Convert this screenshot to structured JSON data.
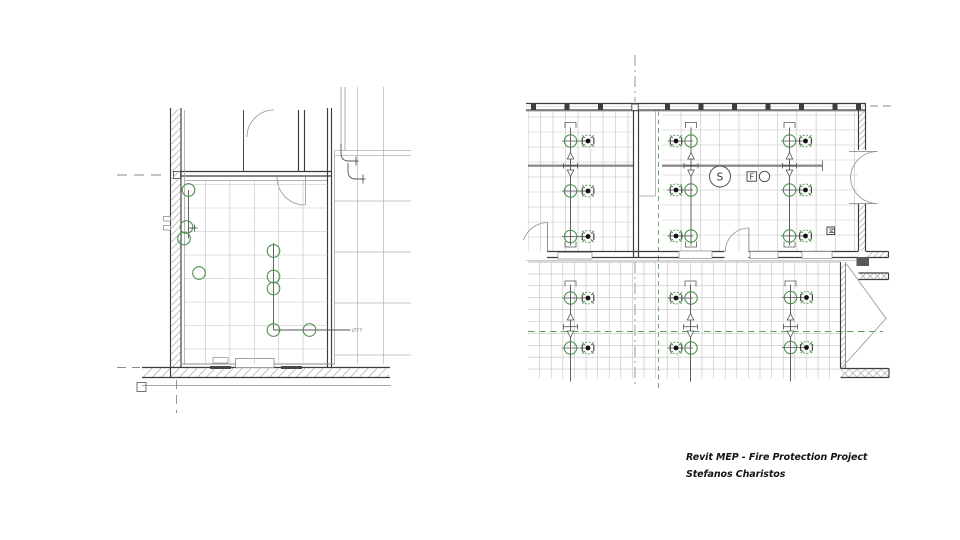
{
  "annotation": {
    "line1": "Revit MEP - Fire Protection Project",
    "line2": "Stefanos Charistos"
  },
  "labels": {
    "smoke_detector": "S",
    "fire_device": "F",
    "monitor_module": "M",
    "pipe_note": "Ø77"
  },
  "colors": {
    "wall": "#3c3c3c",
    "wall_mid": "#6e6e6e",
    "grid": "#c2c2c2",
    "grid_dark": "#a8a8a8",
    "hatch": "#9e9e9e",
    "beam": "#8c8c8c",
    "centerline": "#8a8a8a",
    "door": "#949494",
    "pipe": "#4f4f4f",
    "green": "#4e8f4e",
    "green_dash": "#53a353",
    "dot": "#111111",
    "device": "#3f3f3f"
  },
  "left_plan": {
    "sprinklers": [
      {
        "x": 188.5,
        "y": 190
      },
      {
        "x": 186.5,
        "y": 227
      },
      {
        "x": 184.0,
        "y": 238.5
      },
      {
        "x": 273.5,
        "y": 251
      },
      {
        "x": 199.0,
        "y": 273
      },
      {
        "x": 273.5,
        "y": 276.5
      },
      {
        "x": 273.5,
        "y": 288.5
      },
      {
        "x": 273.5,
        "y": 330
      },
      {
        "x": 309.5,
        "y": 330
      }
    ]
  },
  "right_plan": {
    "sprinkler_pairs": [
      {
        "cx": 570.5,
        "dx": 588.0,
        "y": 141.0
      },
      {
        "cx": 570.5,
        "dx": 588.0,
        "y": 191.0
      },
      {
        "cx": 570.5,
        "dx": 588.0,
        "y": 236.5
      },
      {
        "cx": 691.0,
        "dx": 676.0,
        "y": 141.0
      },
      {
        "cx": 691.0,
        "dx": 676.0,
        "y": 190.0
      },
      {
        "cx": 691.0,
        "dx": 676.0,
        "y": 236.0
      },
      {
        "cx": 789.5,
        "dx": 805.5,
        "y": 141.0
      },
      {
        "cx": 789.5,
        "dx": 805.5,
        "y": 190.0
      },
      {
        "cx": 789.5,
        "dx": 805.5,
        "y": 236.0
      },
      {
        "cx": 570.5,
        "dx": 588.0,
        "y": 298.0
      },
      {
        "cx": 570.5,
        "dx": 588.0,
        "y": 348.0
      },
      {
        "cx": 691.0,
        "dx": 676.0,
        "y": 298.0
      },
      {
        "cx": 691.0,
        "dx": 676.0,
        "y": 348.0
      },
      {
        "cx": 790.5,
        "dx": 806.5,
        "y": 297.5
      },
      {
        "cx": 790.5,
        "dx": 806.5,
        "y": 347.5
      }
    ],
    "pipes_upper": [
      570.5,
      691.0,
      789.5
    ],
    "pipes_lower": [
      570.5,
      690.5,
      790.5
    ]
  }
}
